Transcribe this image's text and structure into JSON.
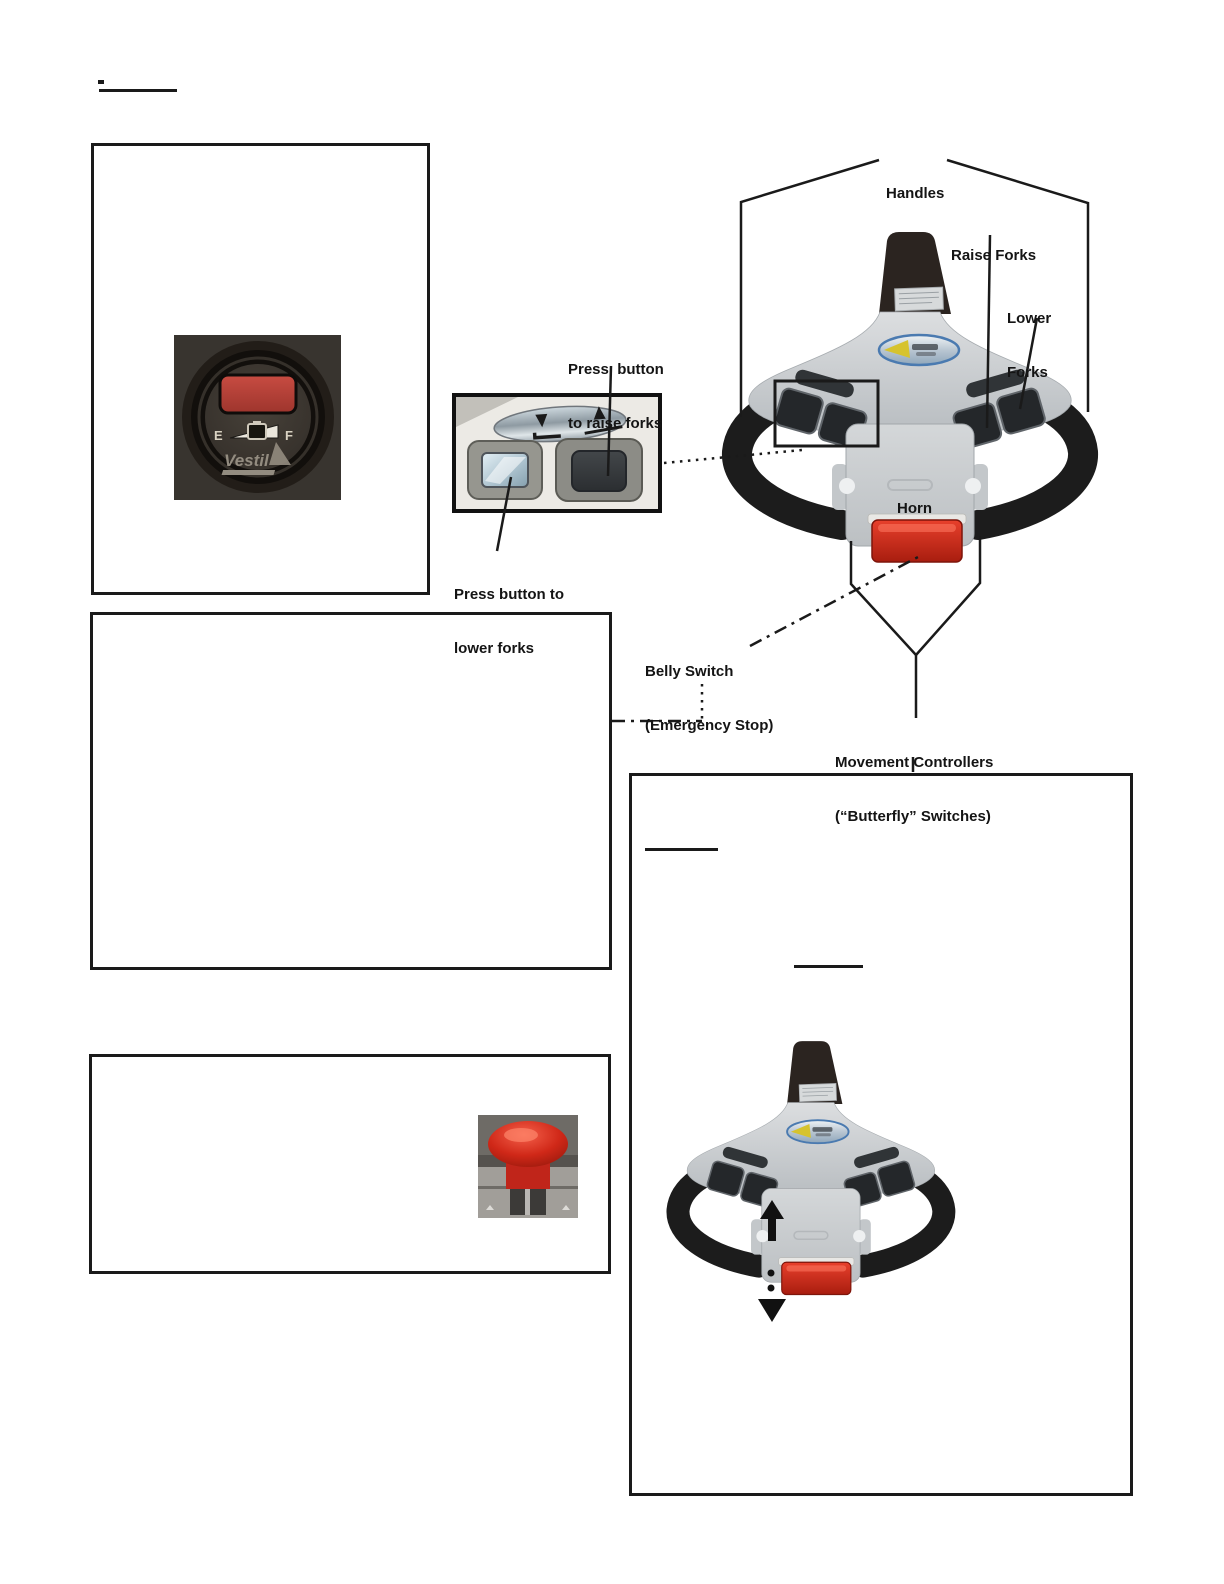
{
  "document": {
    "type": "equipment-manual-page",
    "subject": "Pallet truck control handle diagram page"
  },
  "annotations": {
    "handles": "Handles",
    "raise_forks": "Raise Forks",
    "lower_forks": [
      "Lower",
      "Forks"
    ],
    "horn": "Horn",
    "belly_switch": [
      "Belly Switch",
      "(Emergency Stop)"
    ],
    "movement_controllers": [
      "Movement Controllers",
      "(“Butterfly” Switches)"
    ],
    "press_raise": [
      "Press  button",
      "to raise forks"
    ],
    "press_lower": [
      "Press button to",
      "lower forks"
    ]
  },
  "gauge_photo": {
    "empty": "E",
    "full": "F",
    "brand": "Vestil",
    "display_color": "#b5443a"
  },
  "icons": {
    "raise_button_arrow": "up-arrow",
    "lower_button_arrow": "down-arrow",
    "butterfly_up": "up-arrow",
    "butterfly_down": "down-arrow"
  },
  "colors": {
    "line": "#1a1a1a",
    "head_body_gray": "#c7cbce",
    "handle_black": "#1c1c1c",
    "belly_switch_red": "#c8281a",
    "estop_red": "#d02818"
  }
}
